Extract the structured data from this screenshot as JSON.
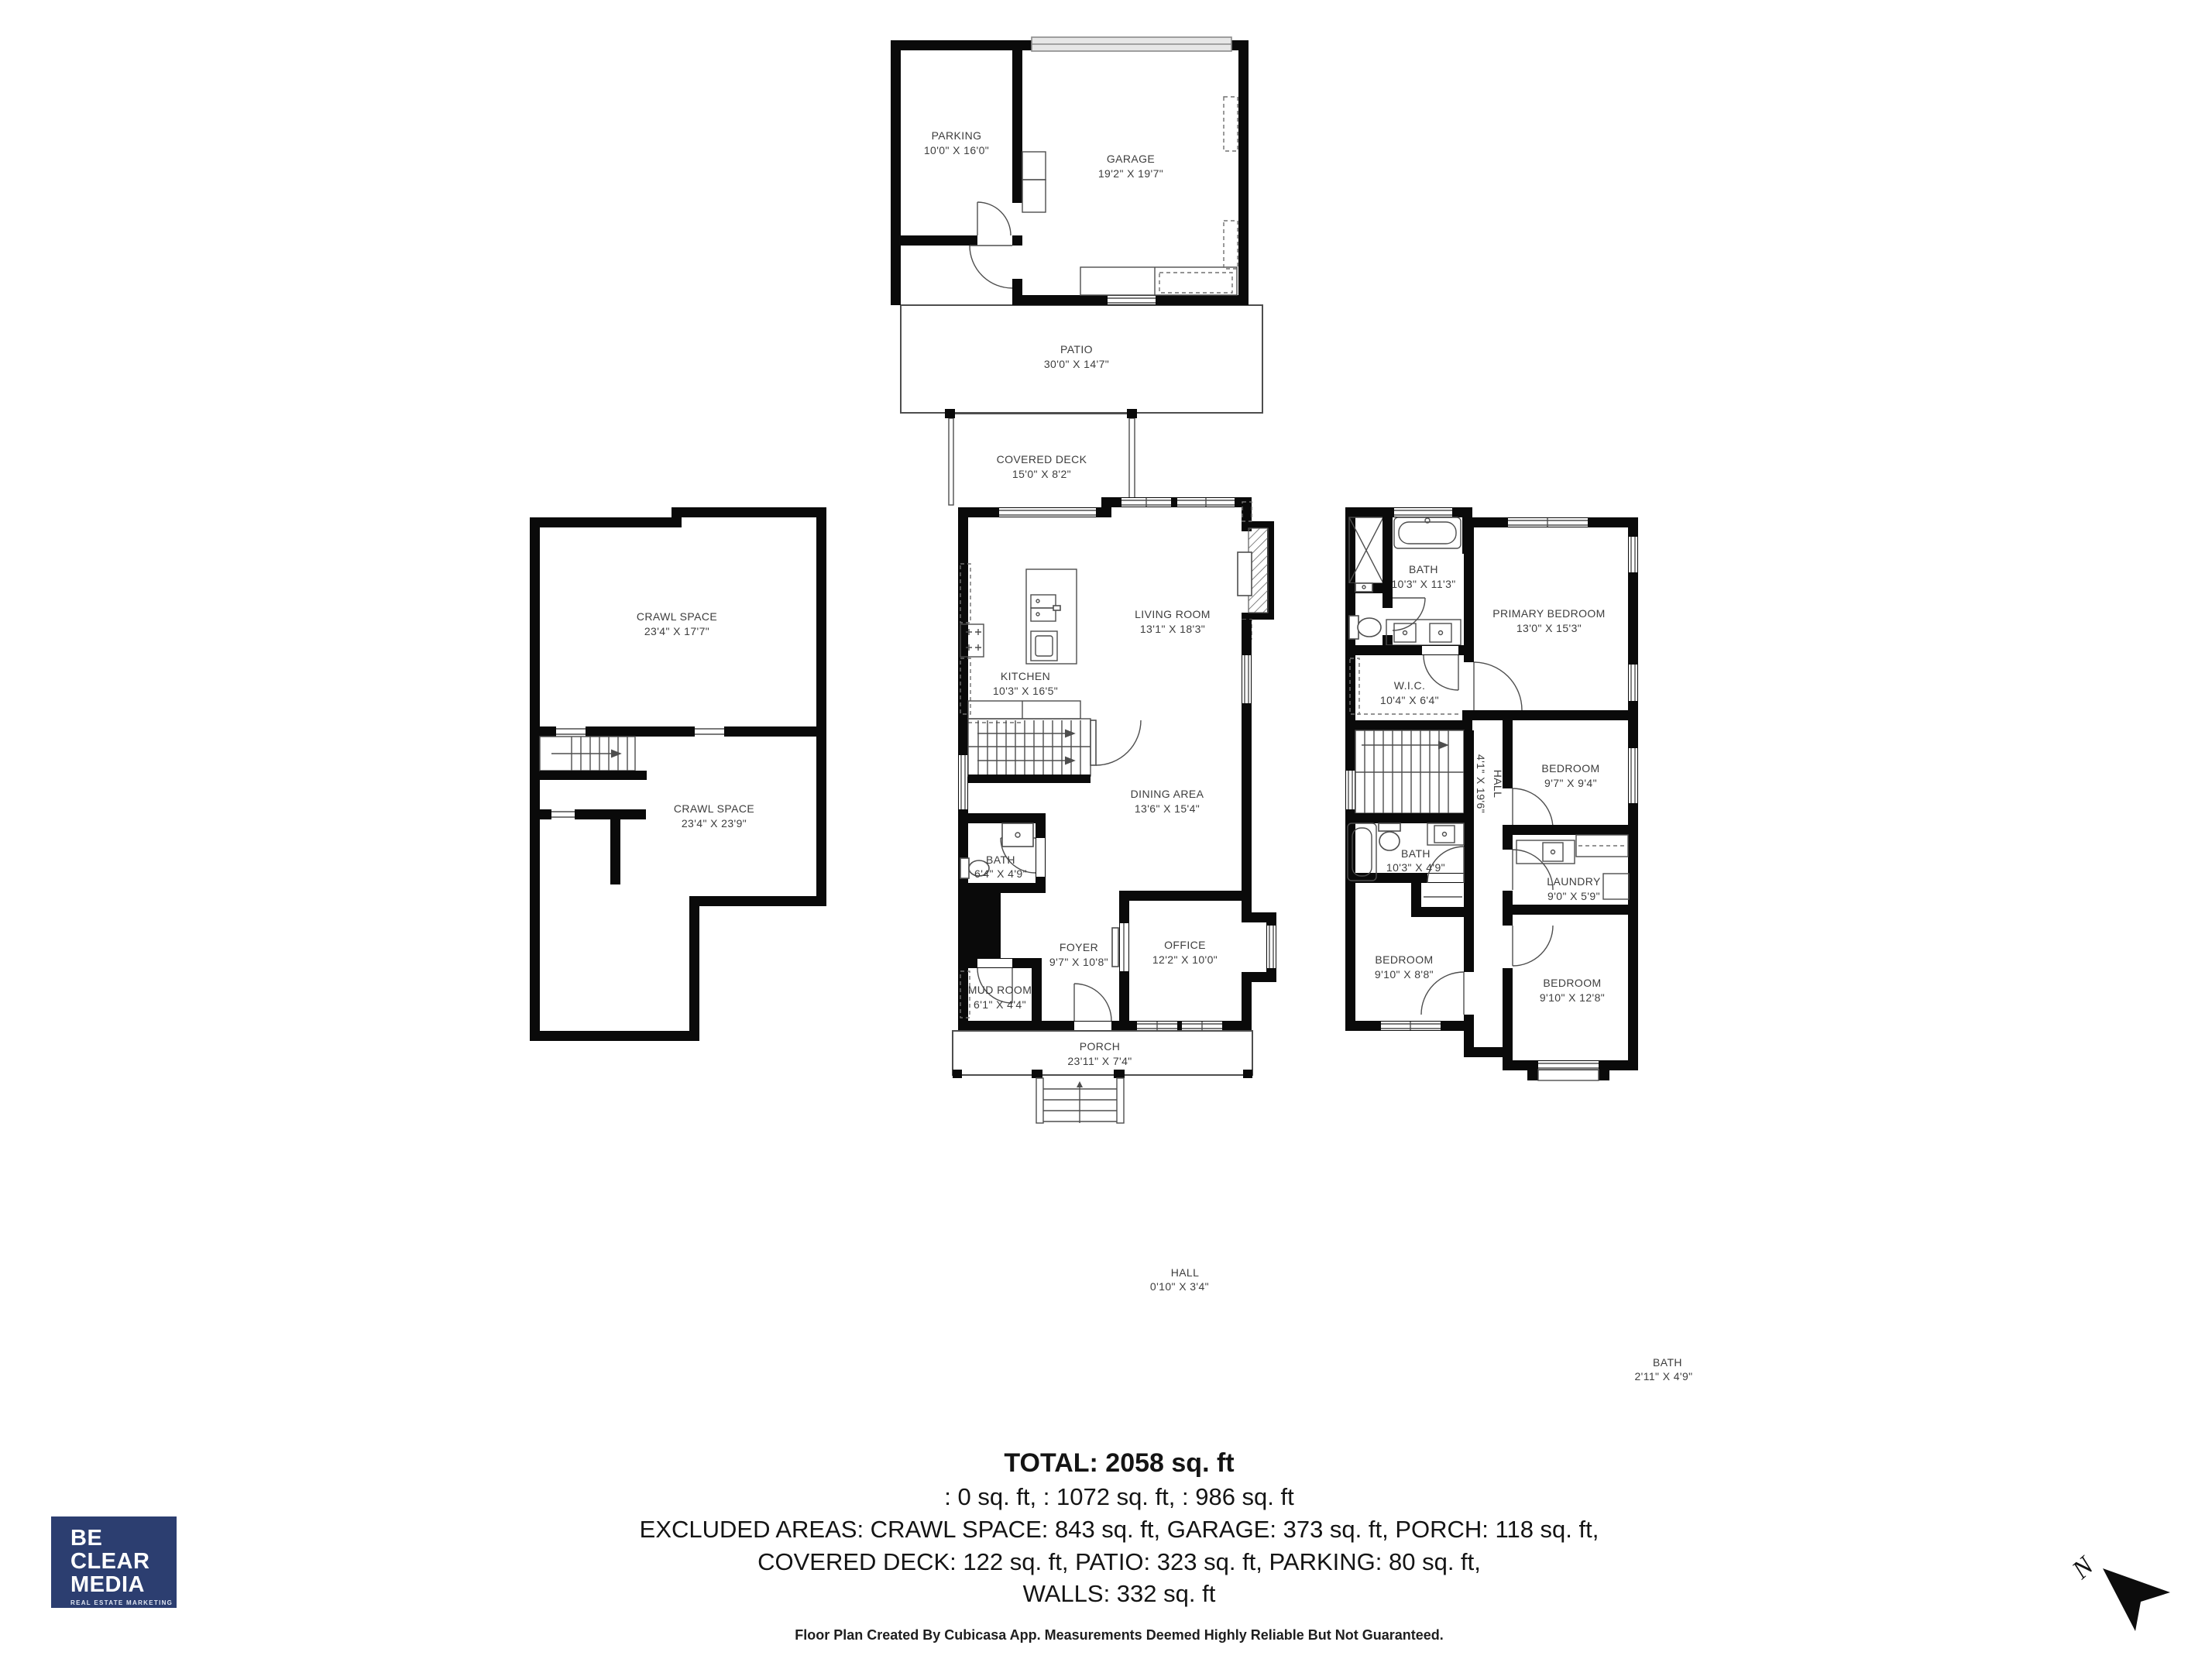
{
  "rooms": {
    "parking": {
      "name": "PARKING",
      "dims": "10'0\" X 16'0\""
    },
    "garage": {
      "name": "GARAGE",
      "dims": "19'2\" X 19'7\""
    },
    "patio": {
      "name": "PATIO",
      "dims": "30'0\" X 14'7\""
    },
    "covered_deck": {
      "name": "COVERED DECK",
      "dims": "15'0\" X 8'2\""
    },
    "crawl_space_upper": {
      "name": "CRAWL SPACE",
      "dims": "23'4\" X 17'7\""
    },
    "crawl_space_lower": {
      "name": "CRAWL SPACE",
      "dims": "23'4\" X 23'9\""
    },
    "kitchen": {
      "name": "KITCHEN",
      "dims": "10'3\" X 16'5\""
    },
    "living_room": {
      "name": "LIVING ROOM",
      "dims": "13'1\" X 18'3\""
    },
    "dining_area": {
      "name": "DINING AREA",
      "dims": "13'6\" X 15'4\""
    },
    "bath_main": {
      "name": "BATH",
      "dims": "6'4\" X 4'9\""
    },
    "foyer": {
      "name": "FOYER",
      "dims": "9'7\" X 10'8\""
    },
    "office": {
      "name": "OFFICE",
      "dims": "12'2\" X 10'0\""
    },
    "mud_room": {
      "name": "MUD ROOM",
      "dims": "6'1\" X 4'4\""
    },
    "porch": {
      "name": "PORCH",
      "dims": "23'11\" X 7'4\""
    },
    "bath_upper": {
      "name": "BATH",
      "dims": "10'3\" X 11'3\""
    },
    "primary_bedroom": {
      "name": "PRIMARY BEDROOM",
      "dims": "13'0\" X 15'3\""
    },
    "wic": {
      "name": "W.I.C.",
      "dims": "10'4\" X 6'4\""
    },
    "hall_upper": {
      "name": "HALL",
      "dims": "4'1\" X 19'6\""
    },
    "bedroom_mid": {
      "name": "BEDROOM",
      "dims": "9'7\" X 9'4\""
    },
    "bath_upper_small": {
      "name": "BATH",
      "dims": "10'3\" X 4'9\""
    },
    "laundry": {
      "name": "LAUNDRY",
      "dims": "9'0\" X 5'9\""
    },
    "bedroom_left": {
      "name": "BEDROOM",
      "dims": "9'10\" X 8'8\""
    },
    "bedroom_right": {
      "name": "BEDROOM",
      "dims": "9'10\" X 12'8\""
    },
    "hall_float": {
      "name": "HALL",
      "dims": "0'10\" X 3'4\""
    },
    "bath_float": {
      "name": "BATH",
      "dims": "2'11\" X 4'9\""
    }
  },
  "summary": {
    "total": "TOTAL: 2058 sq. ft",
    "floors_line": ": 0 sq. ft, : 1072 sq. ft, : 986 sq. ft",
    "excluded_line1": "EXCLUDED AREAS: CRAWL SPACE: 843 sq. ft, GARAGE: 373 sq. ft, PORCH: 118 sq. ft,",
    "excluded_line2": "COVERED DECK: 122 sq. ft, PATIO: 323 sq. ft, PARKING: 80 sq. ft,",
    "walls_line": "WALLS: 332 sq. ft",
    "disclaimer": "Floor Plan Created By Cubicasa App. Measurements Deemed Highly Reliable But Not Guaranteed."
  },
  "logo": {
    "line1": "BE",
    "line2": "CLEAR",
    "line3": "MEDIA",
    "tagline": "REAL ESTATE MARKETING",
    "bg_color": "#2c3e70"
  },
  "compass": {
    "north_label": "N"
  },
  "colors": {
    "walls": "#0a0a0a",
    "thin_lines": "#4e4e4e",
    "label_text": "#3d3d3d"
  }
}
